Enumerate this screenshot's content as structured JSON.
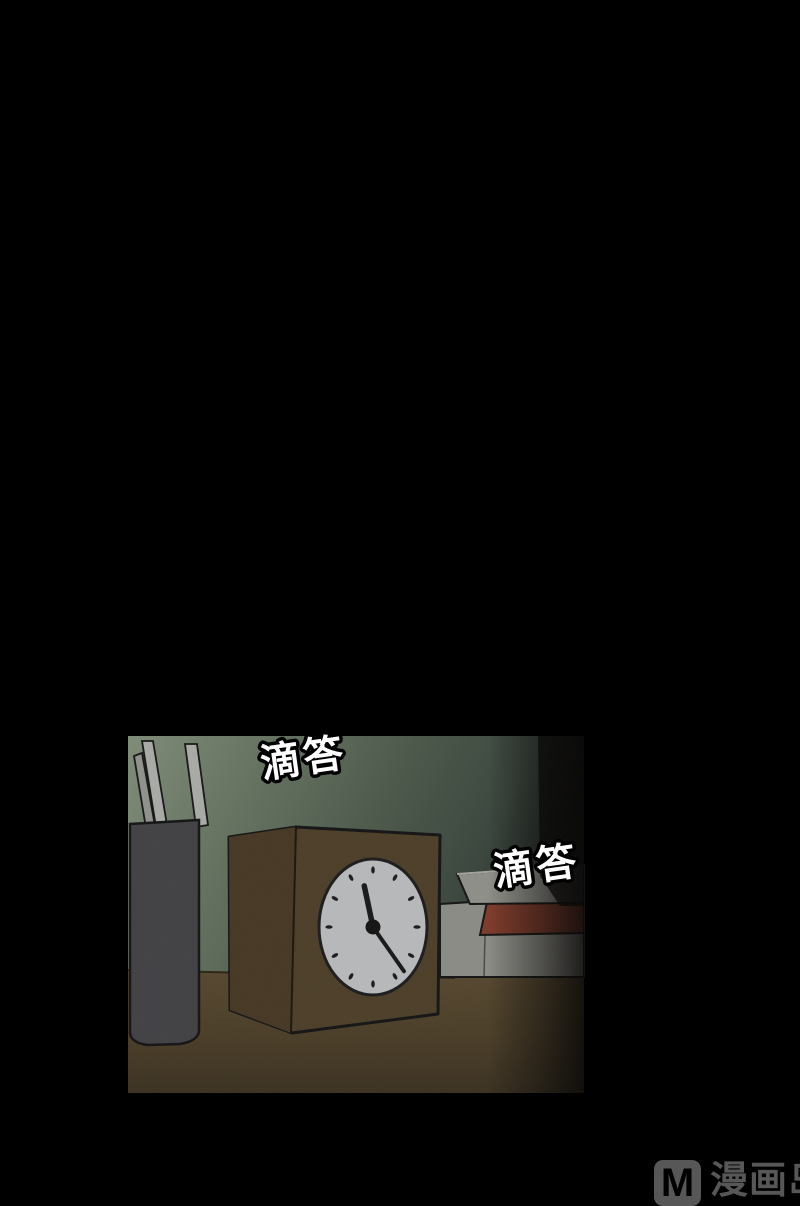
{
  "canvas": {
    "width": 800,
    "height": 1200,
    "background": "#000000"
  },
  "panel": {
    "x": 128,
    "y": 736,
    "width": 456,
    "height": 357,
    "sfx": [
      {
        "text": "滴答"
      },
      {
        "text": "滴答"
      }
    ],
    "clock": {
      "tick_count": 12,
      "hour_hand_angle_deg": -12,
      "minute_hand_angle_deg": 145
    }
  },
  "colors": {
    "wall_light": "#7e8b77",
    "wall_dark": "#2f3931",
    "desk": "#4c3f29",
    "desk_dark": "#3a3020",
    "outline": "#141414",
    "cylinder": "#414144",
    "stick": "#a8aaa5",
    "clock_box": "#4c3e28",
    "clock_box_side": "#453723",
    "clock_face": "#b7b8ba",
    "clock_hands": "#181818",
    "book_red": "#7e3a2a",
    "book_gray": "#8b8b85",
    "box_gray": "#8e8e88",
    "sfx_fill": "#ffffff",
    "sfx_stroke": "#000000",
    "watermark": "#575757"
  },
  "watermark": {
    "logo_letter": "M",
    "brand_text": "漫画岛"
  }
}
